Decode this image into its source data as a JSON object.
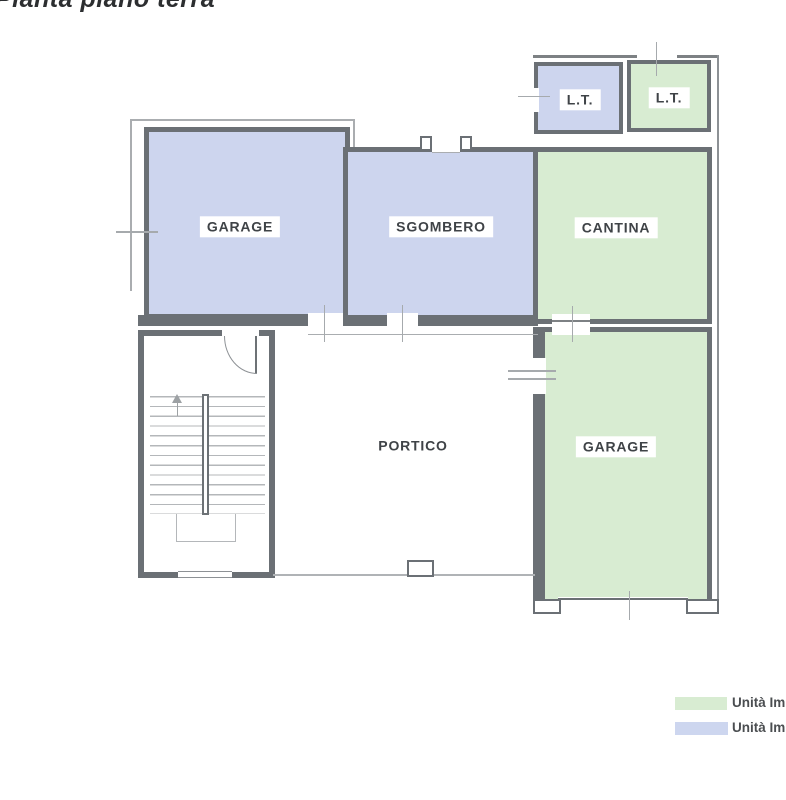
{
  "title": "Pianta piano terra",
  "rooms": {
    "garage_upper": {
      "label": "GARAGE",
      "fill": "#cdd5ee"
    },
    "sgombero": {
      "label": "SGOMBERO",
      "fill": "#cdd5ee"
    },
    "cantina": {
      "label": "CANTINA",
      "fill": "#d8ecd2"
    },
    "lt_left": {
      "label": "L.T.",
      "fill": "#cdd5ee"
    },
    "lt_right": {
      "label": "L.T.",
      "fill": "#d8ecd2"
    },
    "portico": {
      "label": "PORTICO",
      "fill": "#ffffff"
    },
    "garage_lower": {
      "label": "GARAGE",
      "fill": "#d8ecd2"
    }
  },
  "legend": {
    "items": [
      {
        "label": "Unità Im",
        "color": "#d8ecd2"
      },
      {
        "label": "Unità Im",
        "color": "#cdd6ef"
      }
    ]
  },
  "colors": {
    "wall": "#6b7075",
    "thin_line": "#aaadb0",
    "label_text": "#3f4347",
    "background": "#ffffff"
  }
}
